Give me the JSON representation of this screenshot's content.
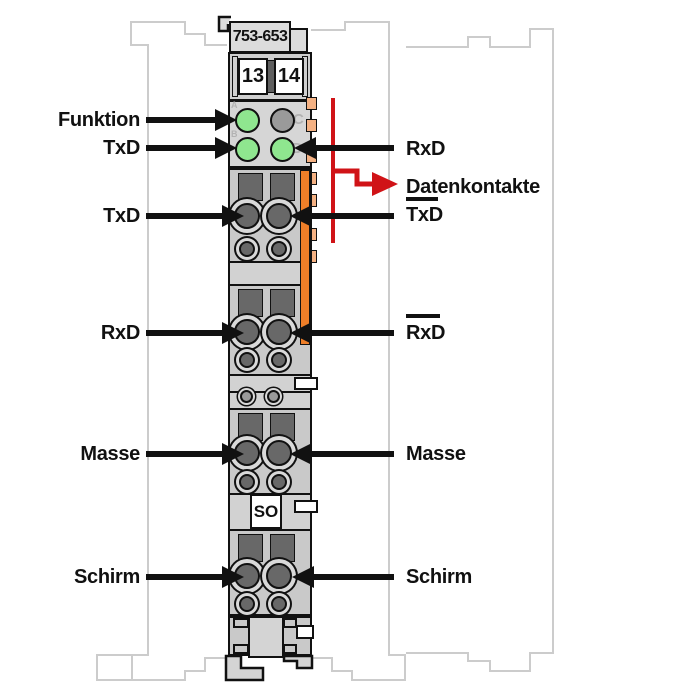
{
  "diagram": {
    "module": {
      "part_number": "753-653",
      "terminal_numbers": [
        "13",
        "14"
      ],
      "marking": "SO",
      "led_labels": {
        "a": "A",
        "b": "B",
        "c": "C",
        "d": "D"
      }
    },
    "left_labels": {
      "funktion": "Funktion",
      "txd_led": "TxD",
      "txd": "TxD",
      "rxd": "RxD",
      "masse": "Masse",
      "schirm": "Schirm"
    },
    "right_labels": {
      "rxd_led": "RxD",
      "datenkontakte": "Datenkontakte",
      "txd_inverted": "TxD",
      "rxd_inverted": "RxD",
      "masse": "Masse",
      "schirm": "Schirm"
    }
  },
  "colors": {
    "led_green": "#8fe68f",
    "led_off_gray": "#9a9a9a",
    "contact_orange": "#ee7e28",
    "tab_orange": "#f4b183",
    "module_gray": "#d2d2d2",
    "section_gray": "#c9c9c9",
    "hole_dark_gray": "#686868",
    "outline_black": "#111111",
    "neighbor_outline_gray": "#cccccc",
    "red": "#d01317"
  }
}
